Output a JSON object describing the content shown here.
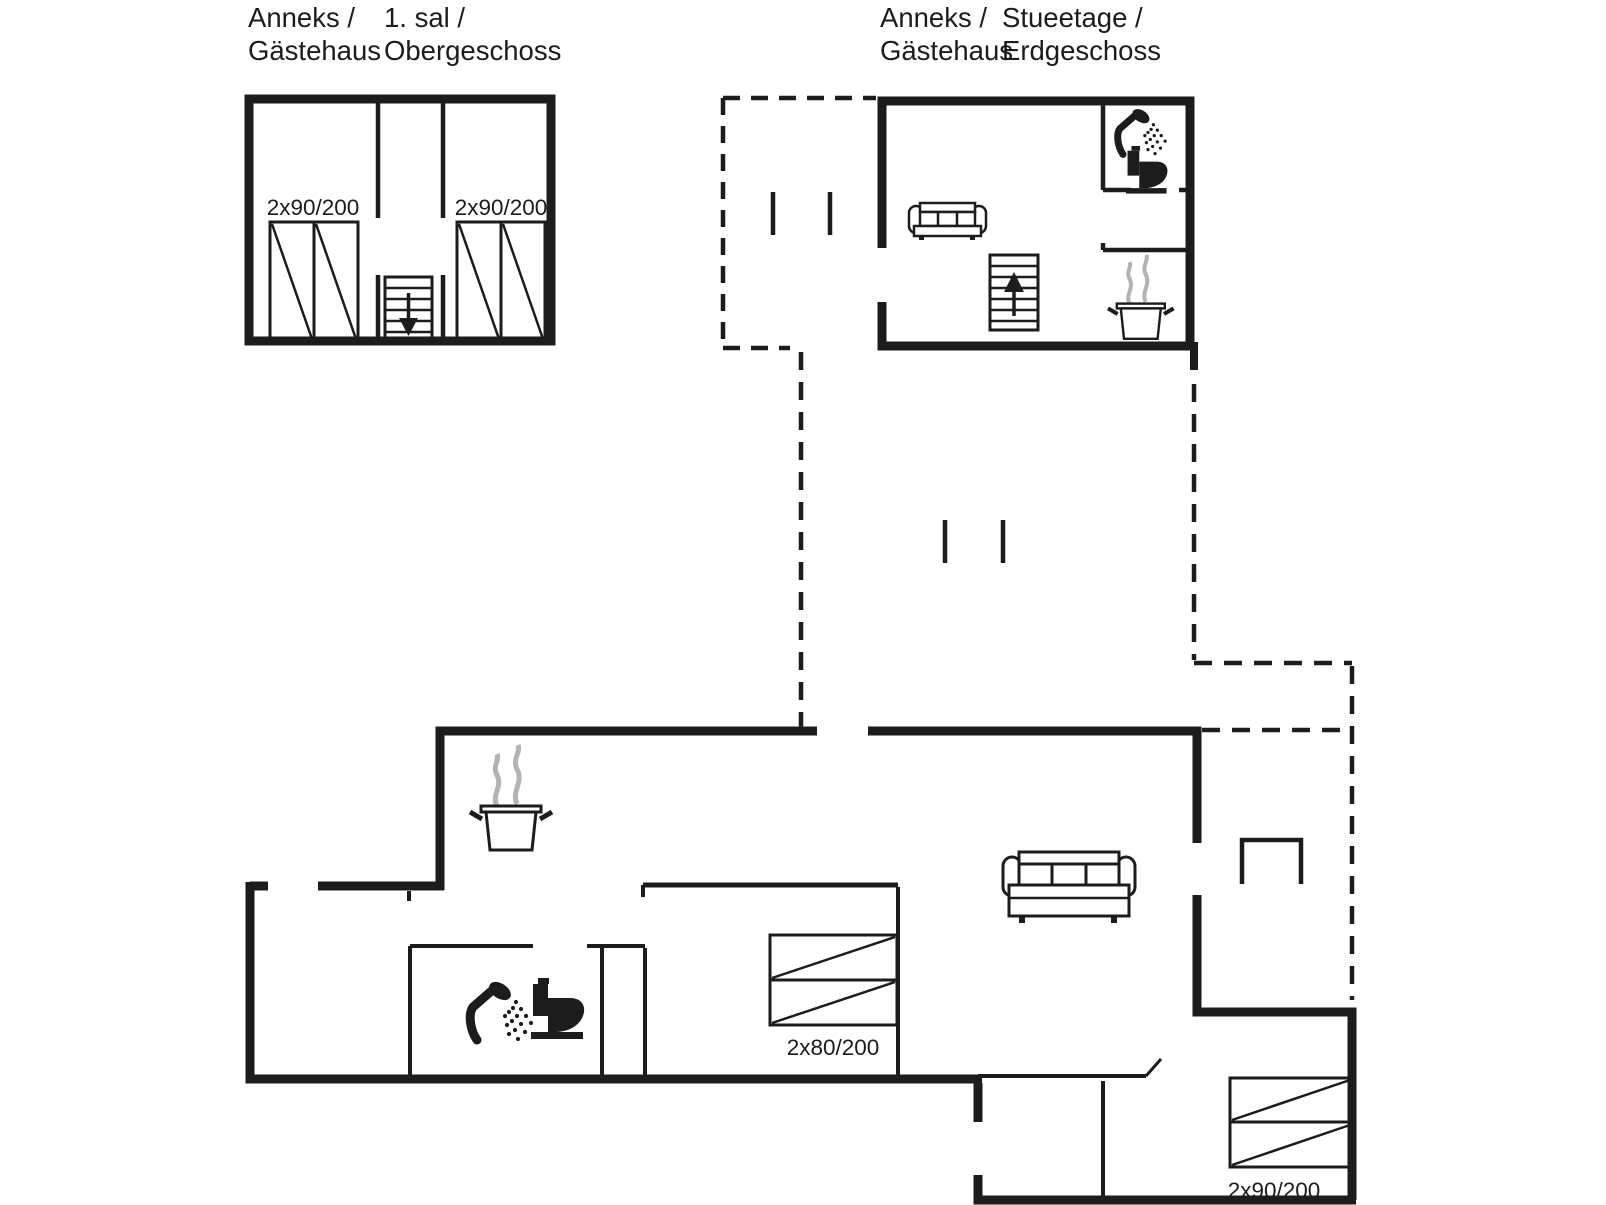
{
  "plans": {
    "annex_upper": {
      "title": {
        "left_top": "Anneks /",
        "left_bottom": "Gästehaus",
        "right_top": "1. sal /",
        "right_bottom": "Obergeschoss"
      },
      "bed_left_label": "2x90/200",
      "bed_right_label": "2x90/200",
      "icons": [
        "double-bed-icon",
        "double-bed-icon",
        "staircase-down-icon"
      ]
    },
    "annex_ground": {
      "title": {
        "left_top": "Anneks /",
        "left_bottom": "Gästehaus",
        "right_top": "Stueetage /",
        "right_bottom": "Erdgeschoss"
      },
      "icons": [
        "sofa-icon",
        "staircase-up-icon",
        "shower-icon",
        "toilet-icon",
        "cooking-pot-icon",
        "terrace-dashed-outline"
      ]
    },
    "main_house": {
      "bed_label_small": "2x80/200",
      "bed_label_large": "2x90/200",
      "icons": [
        "cooking-pot-icon",
        "shower-icon",
        "toilet-icon",
        "sofa-icon",
        "double-bed-icon",
        "double-bed-icon",
        "terrace-furniture-icon"
      ]
    },
    "colors": {
      "wall": "#1c1c1c",
      "steam": "#b3b3b3",
      "background": "#ffffff"
    }
  }
}
